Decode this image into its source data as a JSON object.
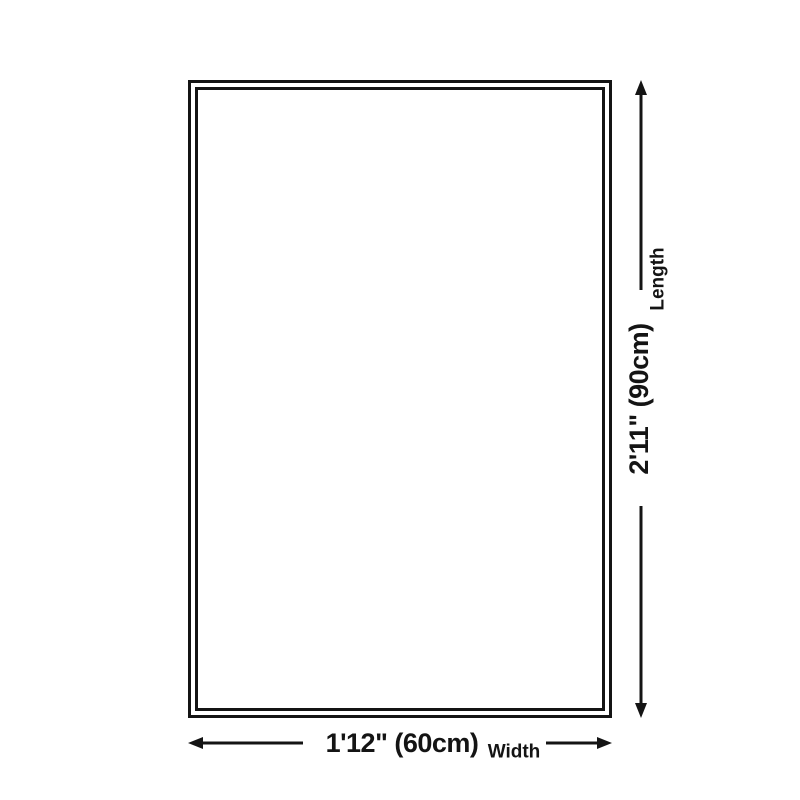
{
  "diagram": {
    "type": "product-dimension-diagram",
    "length": {
      "label": "Length",
      "value": "2'11\" (90cm)"
    },
    "width": {
      "label": "Width",
      "value": "1'12\" (60cm)"
    },
    "colors": {
      "line": "#141414",
      "background": "#ffffff"
    }
  }
}
